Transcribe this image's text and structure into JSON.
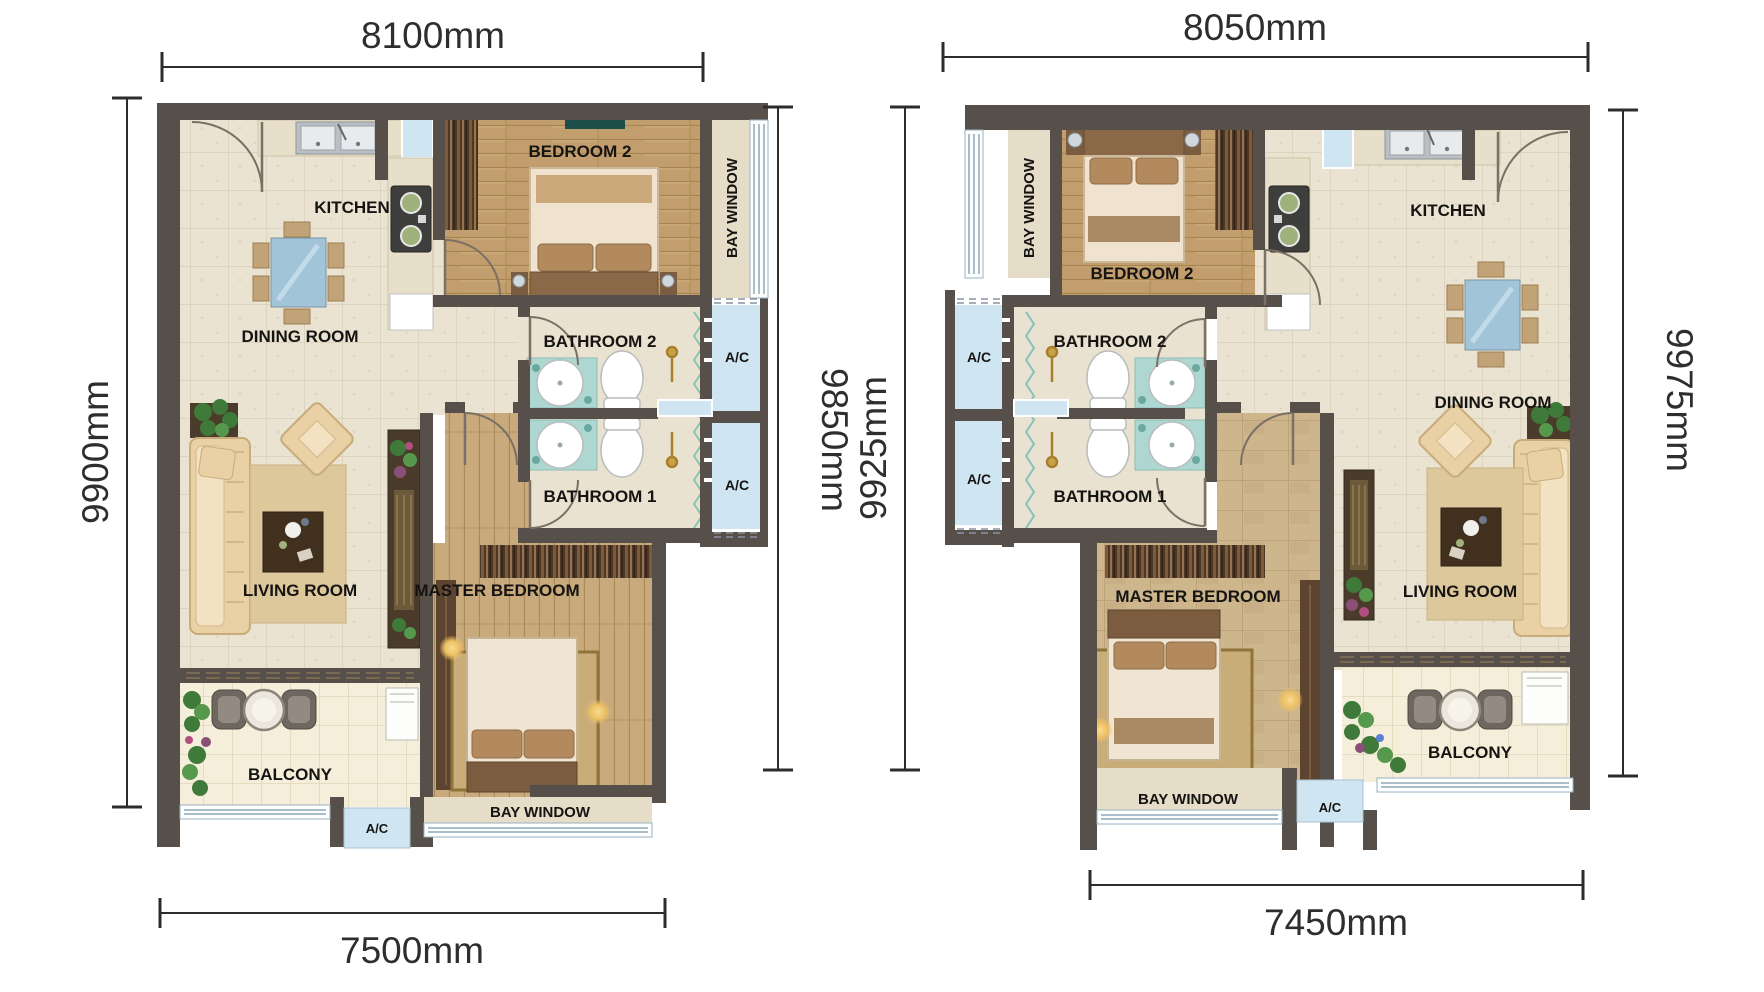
{
  "title": "Two mirrored apartment floor plans",
  "plans": [
    {
      "name": "unit-left",
      "dims": {
        "top": "8100mm",
        "left": "9900mm",
        "right": "9850mm",
        "bottom": "7500mm"
      },
      "labels": {
        "kitchen": "KITCHEN",
        "dining": "DINING ROOM",
        "bedroom2": "BEDROOM 2",
        "bay_side": "BAY WINDOW",
        "bath2": "BATHROOM 2",
        "bath1": "BATHROOM 1",
        "ac_upper": "A/C",
        "ac_lower": "A/C",
        "living": "LIVING ROOM",
        "master": "MASTER BEDROOM",
        "balcony": "BALCONY",
        "ac_bottom": "A/C",
        "bay_bottom": "BAY WINDOW"
      }
    },
    {
      "name": "unit-right",
      "dims": {
        "top": "8050mm",
        "left": "9925mm",
        "right": "9975mm",
        "bottom": "7450mm"
      },
      "labels": {
        "kitchen": "KITCHEN",
        "dining": "DINING ROOM",
        "bedroom2": "BEDROOM 2",
        "bay_side": "BAY WINDOW",
        "bath2": "BATHROOM 2",
        "bath1": "BATHROOM 1",
        "ac_upper": "A/C",
        "ac_lower": "A/C",
        "living": "LIVING ROOM",
        "master": "MASTER BEDROOM",
        "balcony": "BALCONY",
        "ac_bottom": "A/C",
        "bay_bottom": "BAY WINDOW"
      }
    }
  ],
  "colors": {
    "wall": "#57504a",
    "tile_floor": "#eae3d1",
    "balcony_tile": "#f4eeda",
    "wood_floor": "#c29e6e",
    "master_wood": "#cdb58c",
    "window_blue": "#cfe6f2",
    "label_text": "#161412",
    "dimension_text": "#2e2e2e"
  }
}
